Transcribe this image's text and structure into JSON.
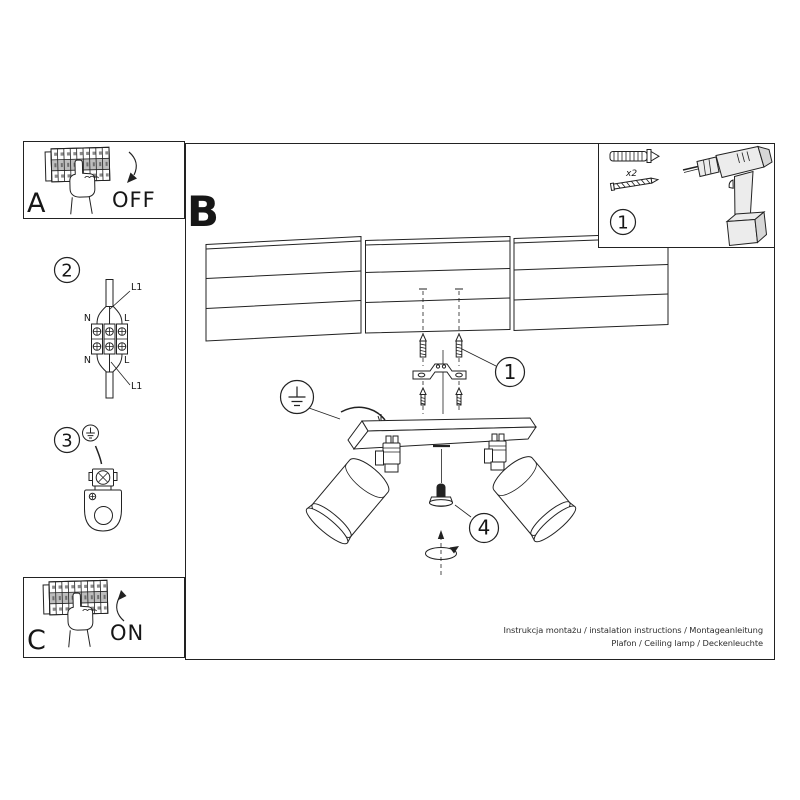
{
  "colors": {
    "ink": "#222222",
    "paper": "#ffffff",
    "shade": "#ececec",
    "shade-dark": "#d7d7d7",
    "switch": "#bdbdbd"
  },
  "frames": {
    "breaker_off": {
      "label": "A",
      "state": "OFF"
    },
    "breaker_on": {
      "label": "C",
      "state": "ON"
    },
    "main_label": "B",
    "tools": {
      "step_number": "1",
      "quantity_note": "x2"
    }
  },
  "step_badges": {
    "mount": "1",
    "wiring": "2",
    "grounding": "3",
    "adjust": "4"
  },
  "wiring_labels": {
    "top": {
      "neutral": "N",
      "line": "L",
      "line1": "L1"
    },
    "bottom": {
      "neutral": "N",
      "line": "L",
      "line1": "L1"
    }
  },
  "footer": {
    "line1": "Instrukcja montażu / instalation instructions / Montageanleitung",
    "line2": "Plafon / Ceiling lamp / Deckenleuchte"
  }
}
